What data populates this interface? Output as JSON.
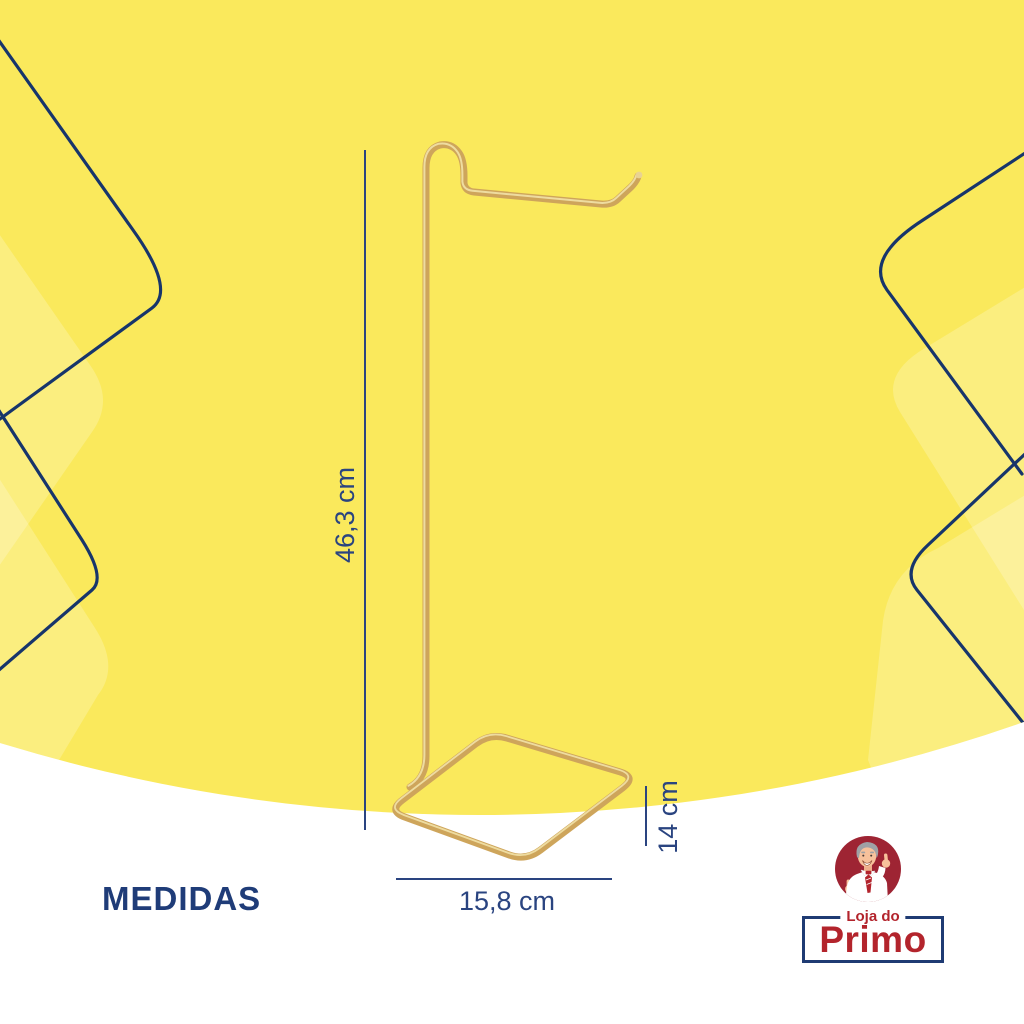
{
  "section_title": "MEDIDAS",
  "product": {
    "name": "headphone-stand",
    "dimensions": {
      "height": "46,3 cm",
      "base_width": "15,8 cm",
      "base_depth": "14 cm"
    }
  },
  "brand": {
    "store_line": "Loja do",
    "store_name": "Primo"
  },
  "colors": {
    "background_yellow": "#FAE95C",
    "decor_outline_navy": "#17356B",
    "dimension_navy": "#2A4480",
    "title_navy": "#1F3C78",
    "product_gold": "#CEA55B",
    "product_gold_highlight": "#EEDCA0",
    "brand_red": "#B3242C",
    "brand_circle_red": "#9E2433",
    "bottom_white": "#FFFFFF"
  },
  "icons": {
    "mascot": "man-thumbs-up-icon"
  }
}
